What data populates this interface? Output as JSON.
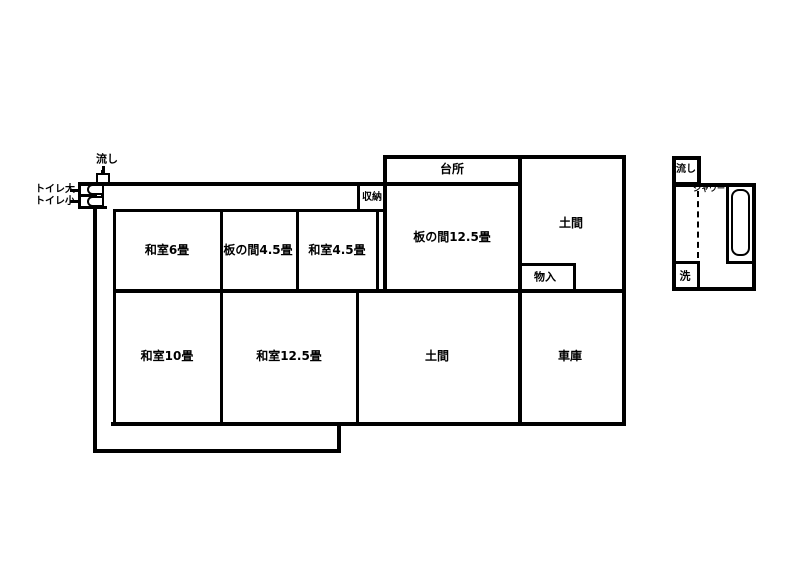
{
  "colors": {
    "line": "#000000",
    "background": "#ffffff"
  },
  "main_house": {
    "rooms": {
      "kitchen": "台所",
      "storage": "収納",
      "itanoma_12_5": "板の間12.5畳",
      "doma_upper": "土間",
      "monoire": "物入",
      "washitsu_6": "和室6畳",
      "itanoma_4_5": "板の間4.5畳",
      "washitsu_4_5": "和室4.5畳",
      "washitsu_10": "和室10畳",
      "washitsu_12_5": "和室12.5畳",
      "doma_lower": "土間",
      "garage": "車庫"
    },
    "fixtures": {
      "sink": "流し",
      "toilet_large": "トイレ大",
      "toilet_small": "トイレ小"
    }
  },
  "outbuilding": {
    "sink": "流し",
    "shower": "シャワー",
    "wash": "洗"
  }
}
